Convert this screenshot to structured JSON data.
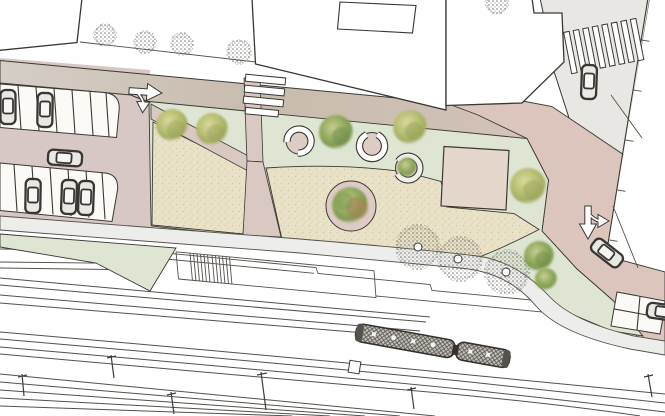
{
  "plan": {
    "kind": "architectural site plan, top view",
    "areas": {
      "plaza": "gravel plaza with lawn strips, round tree planters and a square pavilion slab",
      "railway": "railway corridor with station platform, stairs, tracks and one train",
      "parking_lot": "parking lot with two stall rows and parked cars",
      "streets": "access streets with crosswalks, lane arrows and driving cars"
    }
  },
  "colors": {
    "bg": "#ffffff",
    "outline": "#3b3833",
    "line": "#55504b",
    "road_grey": "#e8e7e3",
    "road_pink": "#dcc5bd",
    "parking": "#d8c8c5",
    "stall": "#fbfaf7",
    "gravel": "#e9e2c8",
    "grass": "#dfe5d3",
    "path_pink": "#dac9c3",
    "walkway": "#ededeb",
    "square": "#e6d7cc",
    "planter": "#ddcbc5",
    "tree_green": "#7e9a52",
    "tree_yellow": "#b8bf74",
    "tree_red": "#a97c4e",
    "stipple": "#6e6a64",
    "car_fill": "#e9e8e5",
    "train_fill": "#c6c3be"
  },
  "counts": {
    "buildings": 4,
    "parking_stalls": 15,
    "parked_cars": 6,
    "cars_driving": 3,
    "stippled_street_trees": 8,
    "canopy_trees": 9,
    "round_tree_planters": 3,
    "crosswalks": 2,
    "turn_arrows": 2,
    "trains": 1,
    "railway_track_lines": 13,
    "catenary_posts": 6
  },
  "labels": {
    "scene": "site plan drawing",
    "buildings": "buildings",
    "main_street": "main street",
    "side_street": "side street",
    "parking_lot": "parking lot",
    "plaza": "plaza",
    "lawn": "lawn",
    "pavilion": "pavilion slab",
    "planter": "tree planter",
    "walkway": "walkway",
    "platform": "station platform",
    "tracks": "railway tracks",
    "train": "train",
    "crosswalk": "pedestrian crossing",
    "turn_arrow": "lane arrow",
    "car": "car",
    "tree": "tree"
  }
}
